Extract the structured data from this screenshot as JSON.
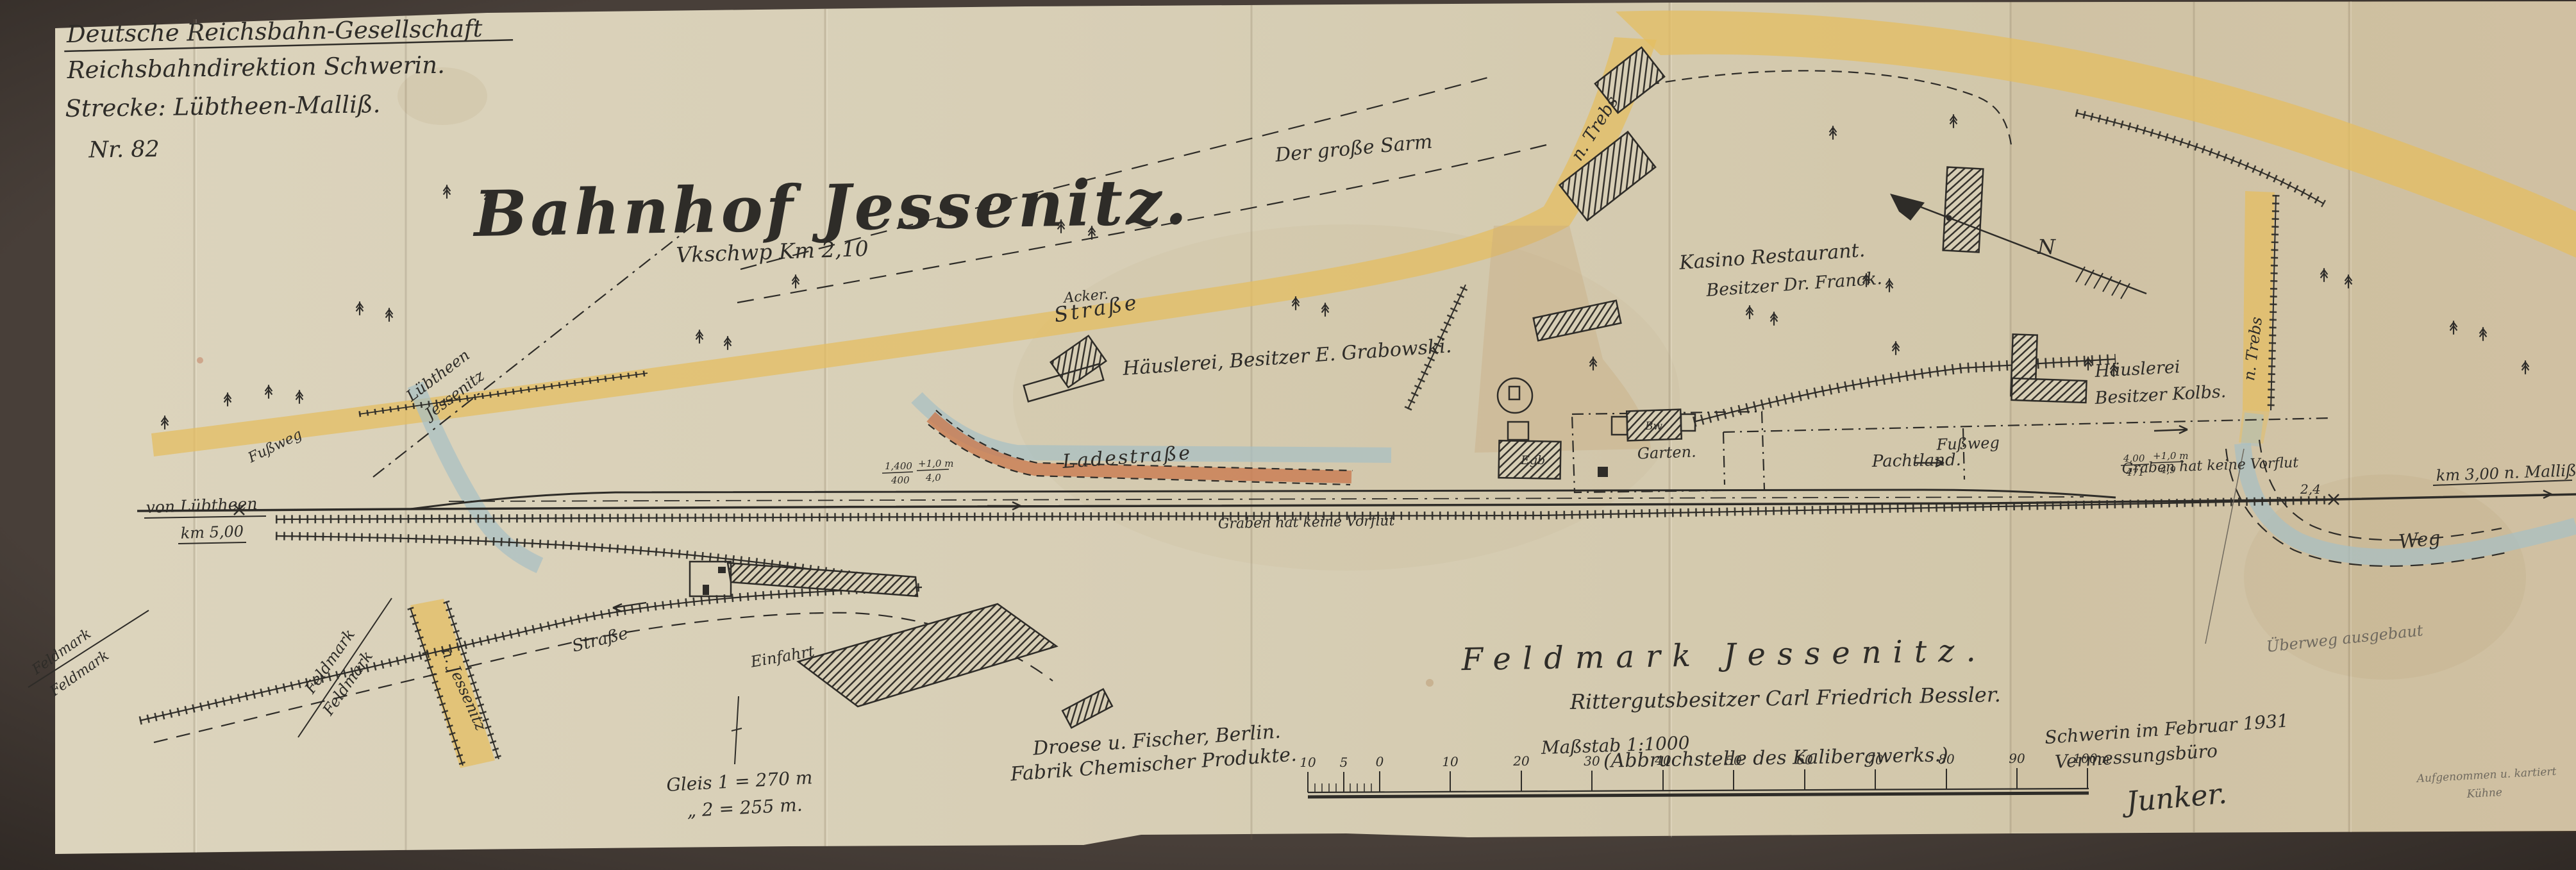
{
  "header": {
    "line1": "Deutsche Reichsbahn-Gesellschaft",
    "line2": "Reichsbahndirektion Schwerin.",
    "line3": "Strecke: Lübtheen-Malliß.",
    "number": "Nr. 82"
  },
  "title": {
    "main": "Bahnhof Jessenitz.",
    "subtitle": "Vkschwp Km 2,10"
  },
  "labels": {
    "der_grosse_sarm": "Der große Sarm",
    "strasse": "Straße",
    "acker": "Acker.",
    "haeuslerei_grabowski": "Häuslerei, Besitzer E. Grabowski.",
    "kasino_restaurant": "Kasino Restaurant.",
    "kasino_besitzer": "Besitzer Dr. Franck.",
    "n_trebs": "n. Trebs",
    "haeuslerei": "Häuslerei",
    "besitzer_kolbs": "Besitzer Kolbs.",
    "luebtheen": "Lübtheen",
    "jessenitz": "Jessenitz",
    "von_luebtheen": "von Lübtheen",
    "km_5": "km 5,00",
    "ladestrasse": "Ladestraße",
    "graben": "Graben hat keine Vorflut",
    "pachtland": "Pachtland.",
    "fussweg": "Fußweg",
    "km_3": "km 3,00",
    "n_malliss": "n. Malliß",
    "weg": "Weg",
    "ueberweg": "Überweg ausgebaut",
    "feldmark_jessenitz": "Feldmark Jessenitz.",
    "rittergutsbesitzer": "Rittergutsbesitzer Carl Friedrich Bessler.",
    "abbruchstelle": "(Abbruchstelle des Kalibergwerks.)",
    "droese": "Droese u. Fischer, Berlin.",
    "fabrik": "Fabrik Chemischer Produkte.",
    "gleis1": "Gleis 1 = 270 m",
    "gleis2": "„  2 = 255 m.",
    "schwerin": "Schwerin im Februar 1931",
    "vermessungsbuero": "Vermessungsbüro",
    "signature": "Junker.",
    "aufgenommen": "Aufgenommen u. kartiert",
    "kuehne": "Kühne",
    "einfahrt": "Einfahrt",
    "feldmark": "Feldmark",
    "n_jessenitz": "n. Jessenitz",
    "garten": "Garten.",
    "egb": "Egb",
    "bw": "Bw",
    "north": "N",
    "mark_24": "2,4",
    "grad1_top": "1,400",
    "grad1_bot": "400",
    "grad2_top": "+1,0 m",
    "grad2_bot": "4,0",
    "grad3_top": "4,00",
    "grad3_bot": "471",
    "grad4_top": "+1,0 m",
    "grad4_bot": "4,9"
  },
  "scalebar": {
    "title": "Maßstab 1:1000",
    "ticks": [
      "10",
      "5",
      "0",
      "10",
      "20",
      "30",
      "40",
      "50",
      "60",
      "70",
      "80",
      "90",
      "100m"
    ]
  },
  "colors": {
    "photo_background": "#453d37",
    "paper": "#d7ceb6",
    "ink": "#2e2c28",
    "road_yellow": "#e4be62",
    "water_blue": "#a7bfc4",
    "ramp_red": "#c97a50",
    "pencil": "#6f695e"
  }
}
